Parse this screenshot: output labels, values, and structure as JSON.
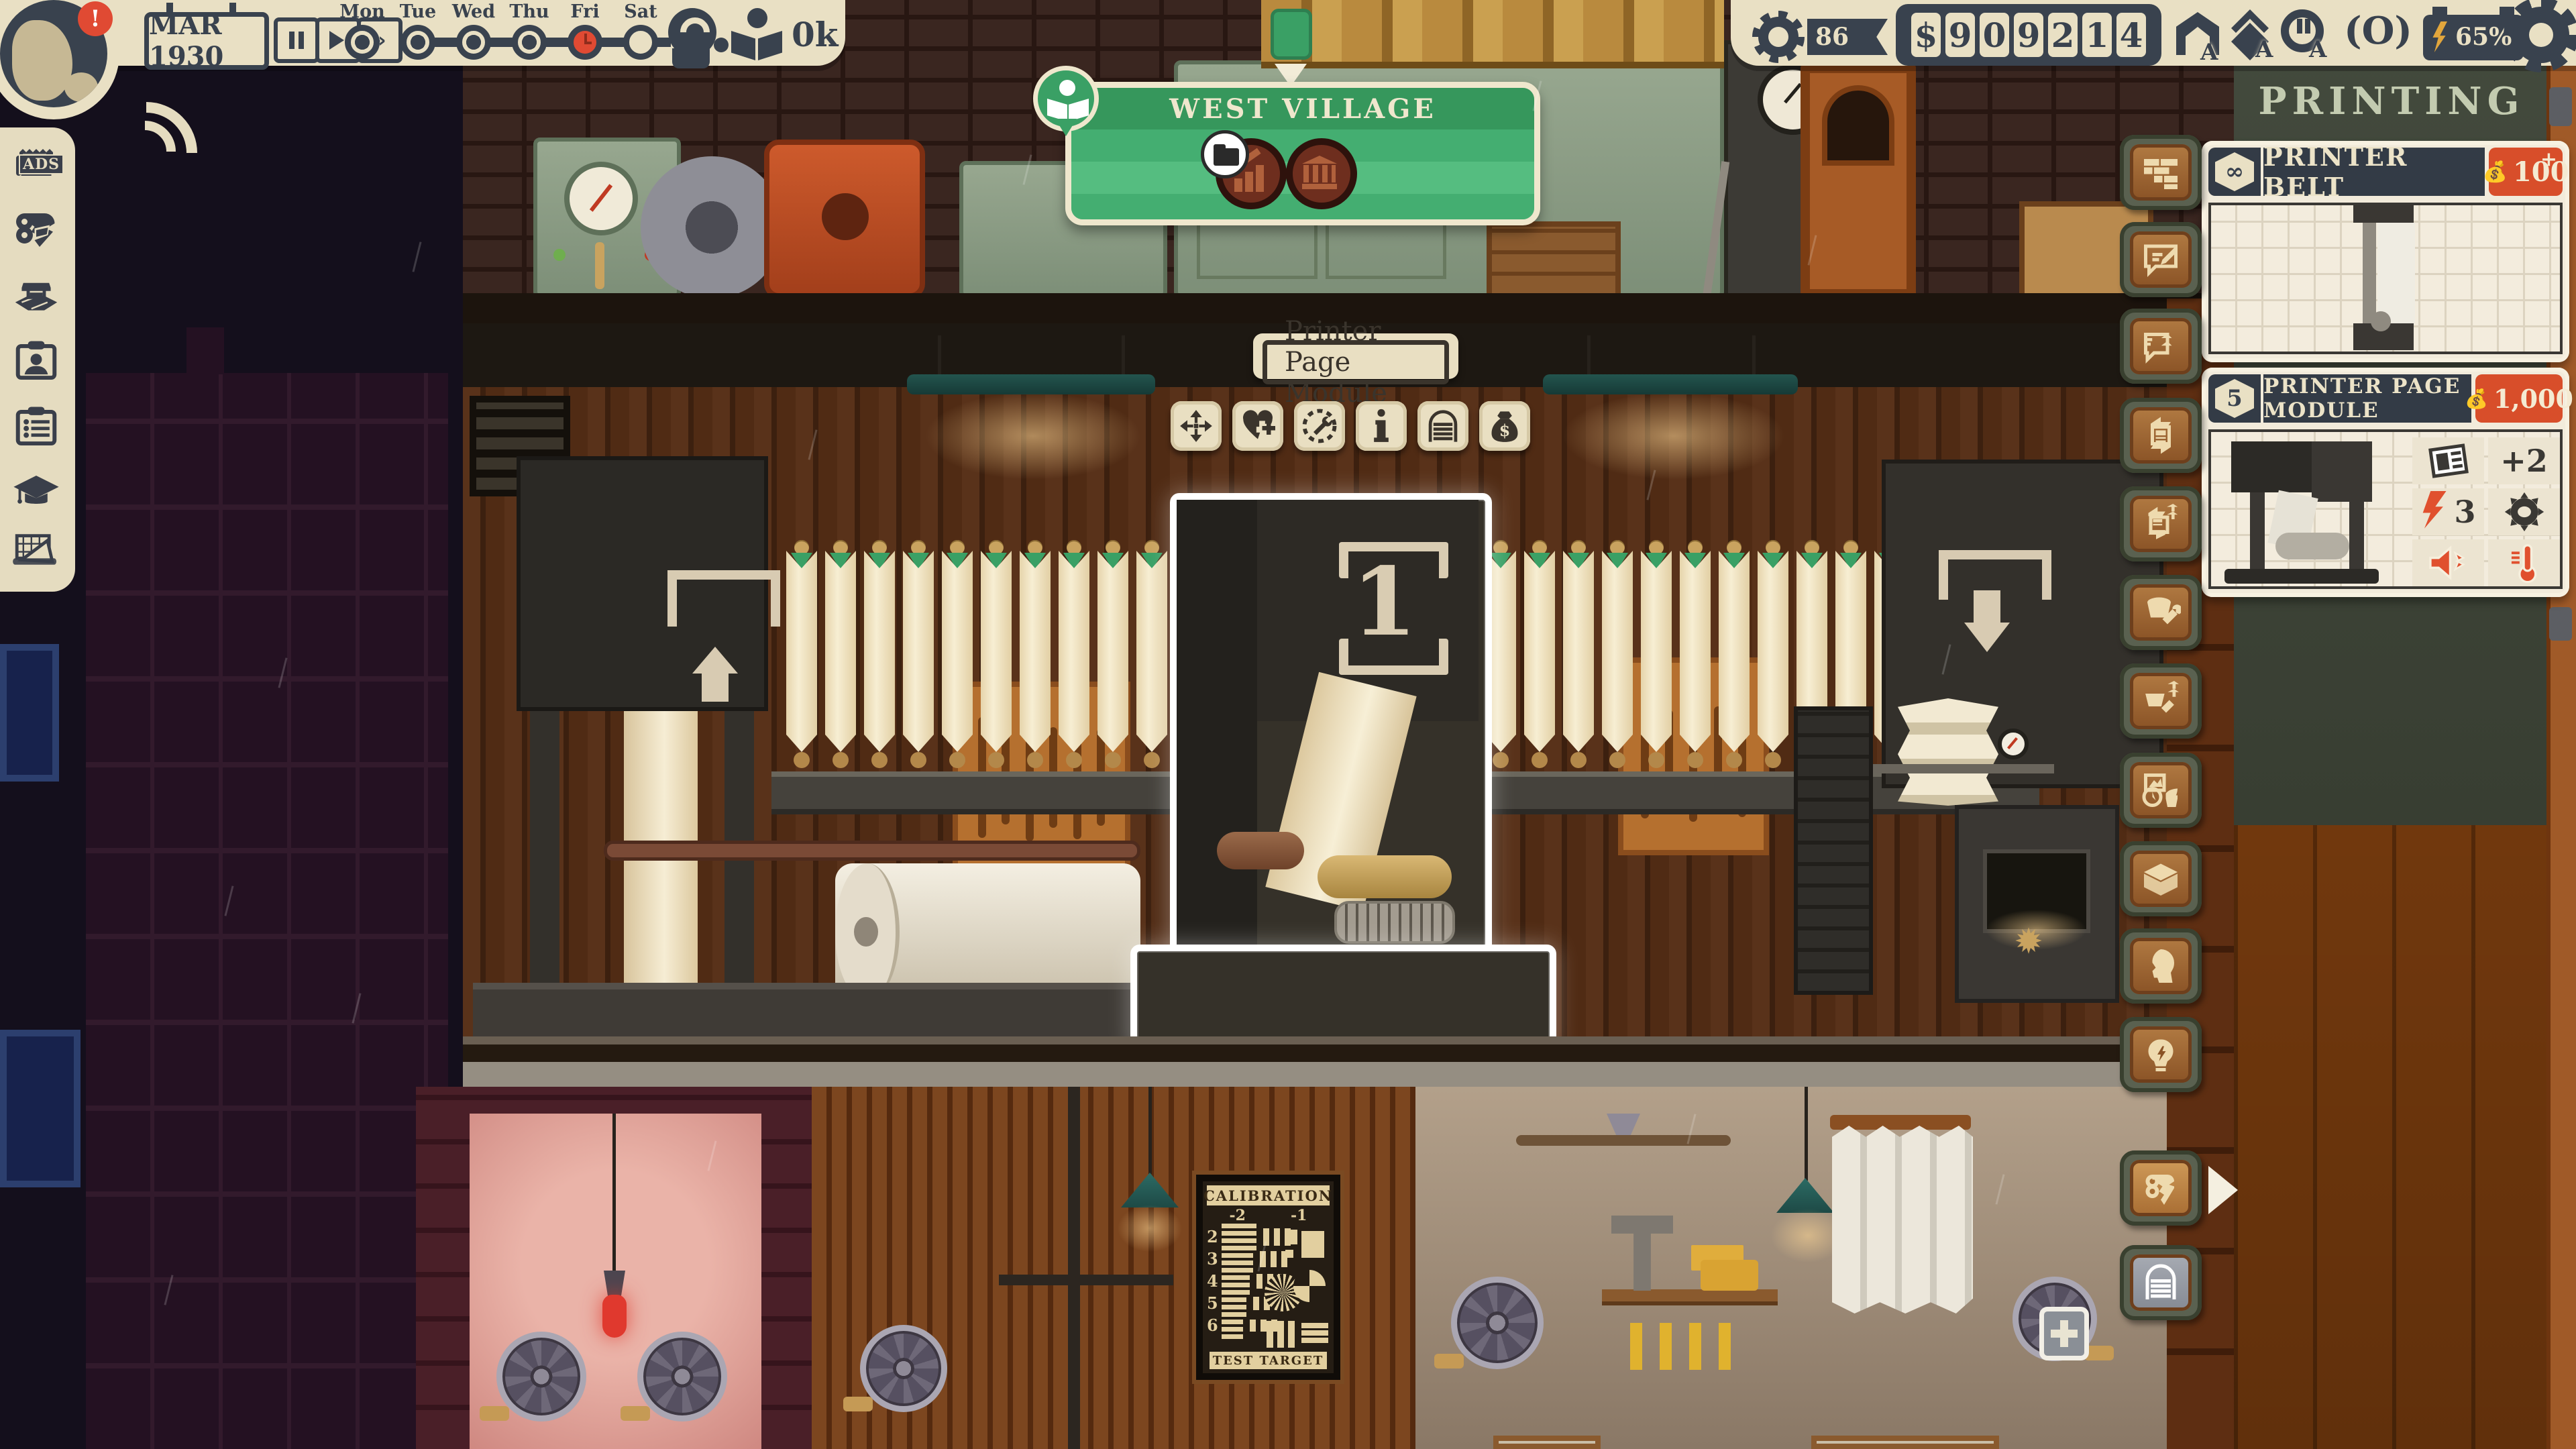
{
  "top_bar": {
    "date": "MAR 1930",
    "alert": "!",
    "controls": [
      {
        "icon": "pause-icon"
      },
      {
        "icon": "play-icon"
      },
      {
        "icon": "fast-forward-icon"
      }
    ],
    "days": [
      {
        "label": "Mon",
        "state": "past"
      },
      {
        "label": "Tue",
        "state": "past"
      },
      {
        "label": "Wed",
        "state": "past"
      },
      {
        "label": "Thu",
        "state": "past"
      },
      {
        "label": "Fri",
        "state": "current"
      },
      {
        "label": "Sat",
        "state": "future"
      }
    ],
    "readers": "0k",
    "reputation": "86",
    "money": {
      "currency": "$",
      "digits": [
        "9",
        "0",
        "9",
        "2",
        "1",
        "4"
      ]
    },
    "battery": "65%",
    "status_icons": [
      "home-icon",
      "pages-icon",
      "city-icon",
      "eye-icon"
    ],
    "status_badge": "A"
  },
  "location_banner": {
    "title": "WEST VILLAGE",
    "badges": [
      "folder-icon",
      "chart-coin-icon",
      "bank-coin-icon"
    ]
  },
  "selection": {
    "tooltip": "Printer Page Module",
    "marker": "1",
    "actions": [
      {
        "icon": "move-icon"
      },
      {
        "icon": "heart-plus-icon"
      },
      {
        "icon": "dial-wrench-icon"
      },
      {
        "icon": "info-icon"
      },
      {
        "icon": "arch-icon"
      },
      {
        "icon": "money-bag-icon"
      }
    ]
  },
  "side_panel": {
    "header": "PRINTING",
    "cards": [
      {
        "badge": "∞",
        "title": "PRINTER BELT",
        "price": "100",
        "price_note": "+"
      },
      {
        "badge": "5",
        "title": "PRINTER PAGE MODULE",
        "price": "1,000",
        "stats": [
          {
            "icon": "newspaper-icon",
            "value": "+2"
          },
          {
            "icon": "bolt-icon",
            "value": "3"
          },
          {
            "icon": "gear-icon",
            "value": ""
          },
          {
            "icon": "speaker-icon",
            "value": ""
          },
          {
            "icon": "thermometer-icon",
            "value": ""
          }
        ]
      }
    ]
  },
  "right_toolbar": [
    {
      "icon": "build-rooms-icon"
    },
    {
      "icon": "write-article-icon"
    },
    {
      "icon": "write-upgrade-icon"
    },
    {
      "icon": "newspaper-cycle-icon"
    },
    {
      "icon": "newspaper-upgrade-icon"
    },
    {
      "icon": "bucket-wrench-icon"
    },
    {
      "icon": "bucket-upgrade-icon"
    },
    {
      "icon": "decor-icon"
    },
    {
      "icon": "storage-box-icon"
    },
    {
      "icon": "staff-head-icon"
    },
    {
      "icon": "bulb-icon"
    },
    {
      "icon": "paper-rolls-icon",
      "active": true
    },
    {
      "icon": "arch-door-icon",
      "gray": true,
      "badge": "+"
    }
  ],
  "left_toolbar": [
    {
      "icon": "ads-icon",
      "label": "ADS"
    },
    {
      "icon": "press-icon"
    },
    {
      "icon": "kiosk-map-icon"
    },
    {
      "icon": "staff-card-icon"
    },
    {
      "icon": "task-list-icon"
    },
    {
      "icon": "grad-cap-icon"
    },
    {
      "icon": "blueprint-icon"
    }
  ],
  "calibration_poster": {
    "title": "CALIBRATION",
    "columns": [
      "-2",
      "-1"
    ],
    "rows": [
      "2",
      "3",
      "4",
      "5",
      "6"
    ],
    "footer": "TEST TARGET"
  },
  "colors": {
    "cream": "#e9e0c4",
    "dark_slate": "#39424e",
    "alert_red": "#e04a33",
    "banner_green": "#44ae71",
    "price_red": "#d84e2a",
    "panel_olive": "#3e4338",
    "button_brown": "#a8713c",
    "highlight_white": "#ffffff"
  }
}
